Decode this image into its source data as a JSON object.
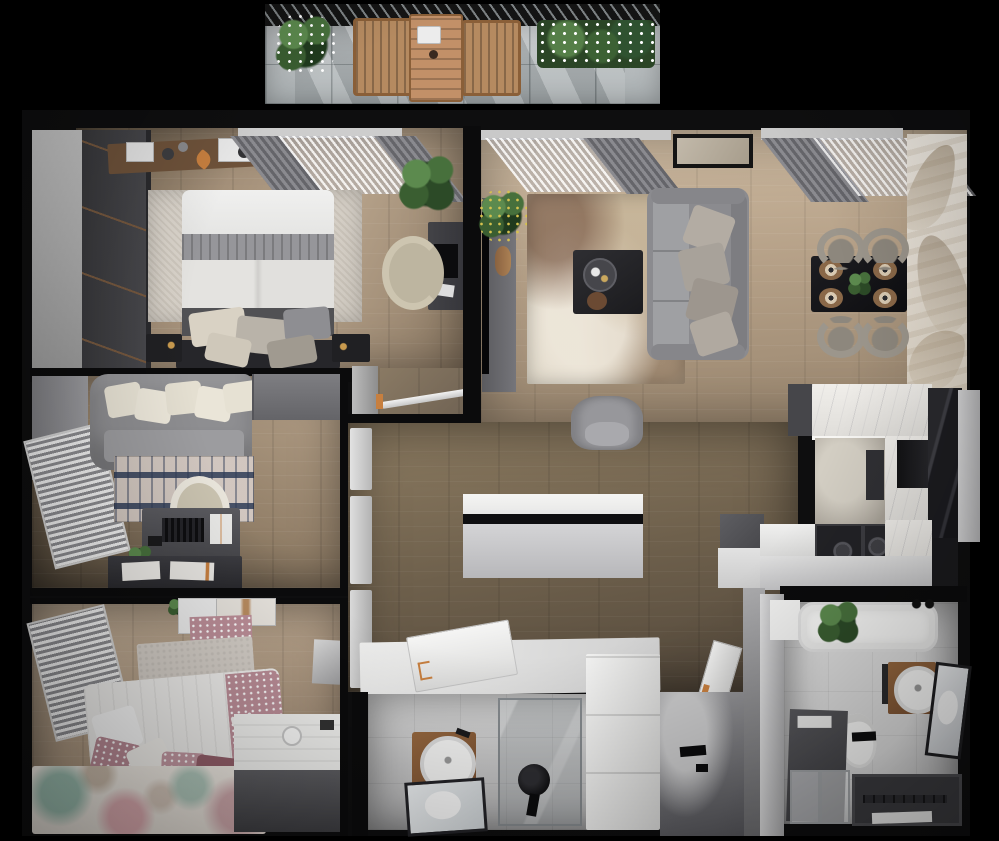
{
  "meta": {
    "type": "3d-floor-plan-render",
    "view": "top-down",
    "width_px": 999,
    "height_px": 841
  },
  "palette": {
    "background": "#000000",
    "wall": "#0b0b0c",
    "wood_light": "#cdbaa1",
    "wood_mid": "#a08b72",
    "wood_dark": "#574b3c",
    "stone": "#b7bcbe",
    "tile": "#c9c9ca",
    "marble": "#edebe7",
    "white_furniture": "#efefee",
    "gray_sofa": "#8e8e91",
    "dark_furniture": "#26262a",
    "wood_accent": "#8a5c39",
    "plant_green": "#3a5e31",
    "accent_orange": "#c77f3f",
    "textile_pink": "#bd8f99",
    "textile_navy": "#2f3c57"
  },
  "scene": {
    "rooms": [
      {
        "id": "balcony",
        "name": "Balcony",
        "features": [
          "stone-tile-floor",
          "railing",
          "wooden-bistro-table",
          "two-wooden-chairs",
          "flower-planters"
        ]
      },
      {
        "id": "master-bedroom",
        "name": "Master bedroom",
        "features": [
          "double-bed",
          "area-rug",
          "wardrobe",
          "decor-shelf",
          "window-curtains",
          "potted-plant",
          "desk",
          "chair",
          "nightstands",
          "glass-door"
        ]
      },
      {
        "id": "home-office",
        "name": "Home office / guest room",
        "features": [
          "sofa-with-pillows",
          "patterned-rug",
          "desk",
          "keyboard",
          "notebook",
          "chair",
          "radiator",
          "side-table"
        ]
      },
      {
        "id": "kids-room",
        "name": "Kids room",
        "features": [
          "single-bed",
          "plush-bunny",
          "floral-rug",
          "headboard",
          "dresser",
          "desk",
          "radiator"
        ]
      },
      {
        "id": "living-room",
        "name": "Living room",
        "features": [
          "sofa",
          "armchair",
          "coffee-table",
          "abstract-rug",
          "tv-console",
          "curtained-windows",
          "wall-art",
          "leaf-mural"
        ]
      },
      {
        "id": "dining-area",
        "name": "Dining area",
        "features": [
          "black-dining-table",
          "four-chairs",
          "place-settings",
          "centerpiece-plant"
        ]
      },
      {
        "id": "kitchen",
        "name": "Kitchen",
        "features": [
          "marble-countertop",
          "tall-glass-cabinets",
          "built-in-oven",
          "double-sink",
          "white-island"
        ]
      },
      {
        "id": "hallway",
        "name": "Hallway",
        "features": [
          "wood-floor",
          "white-panel-wardrobe",
          "open-doors"
        ]
      },
      {
        "id": "guest-bathroom",
        "name": "Guest bathroom / laundry",
        "features": [
          "round-basin",
          "wood-vanity",
          "leaning-mirror",
          "glass-partition",
          "black-stool",
          "tall-white-cabinet"
        ]
      },
      {
        "id": "main-bathroom",
        "name": "Main bathroom",
        "features": [
          "bathtub",
          "plant",
          "round-basin",
          "wood-vanity",
          "leaning-mirror",
          "toilet",
          "shower-tray",
          "frosted-screens",
          "dark-bench"
        ]
      }
    ]
  }
}
